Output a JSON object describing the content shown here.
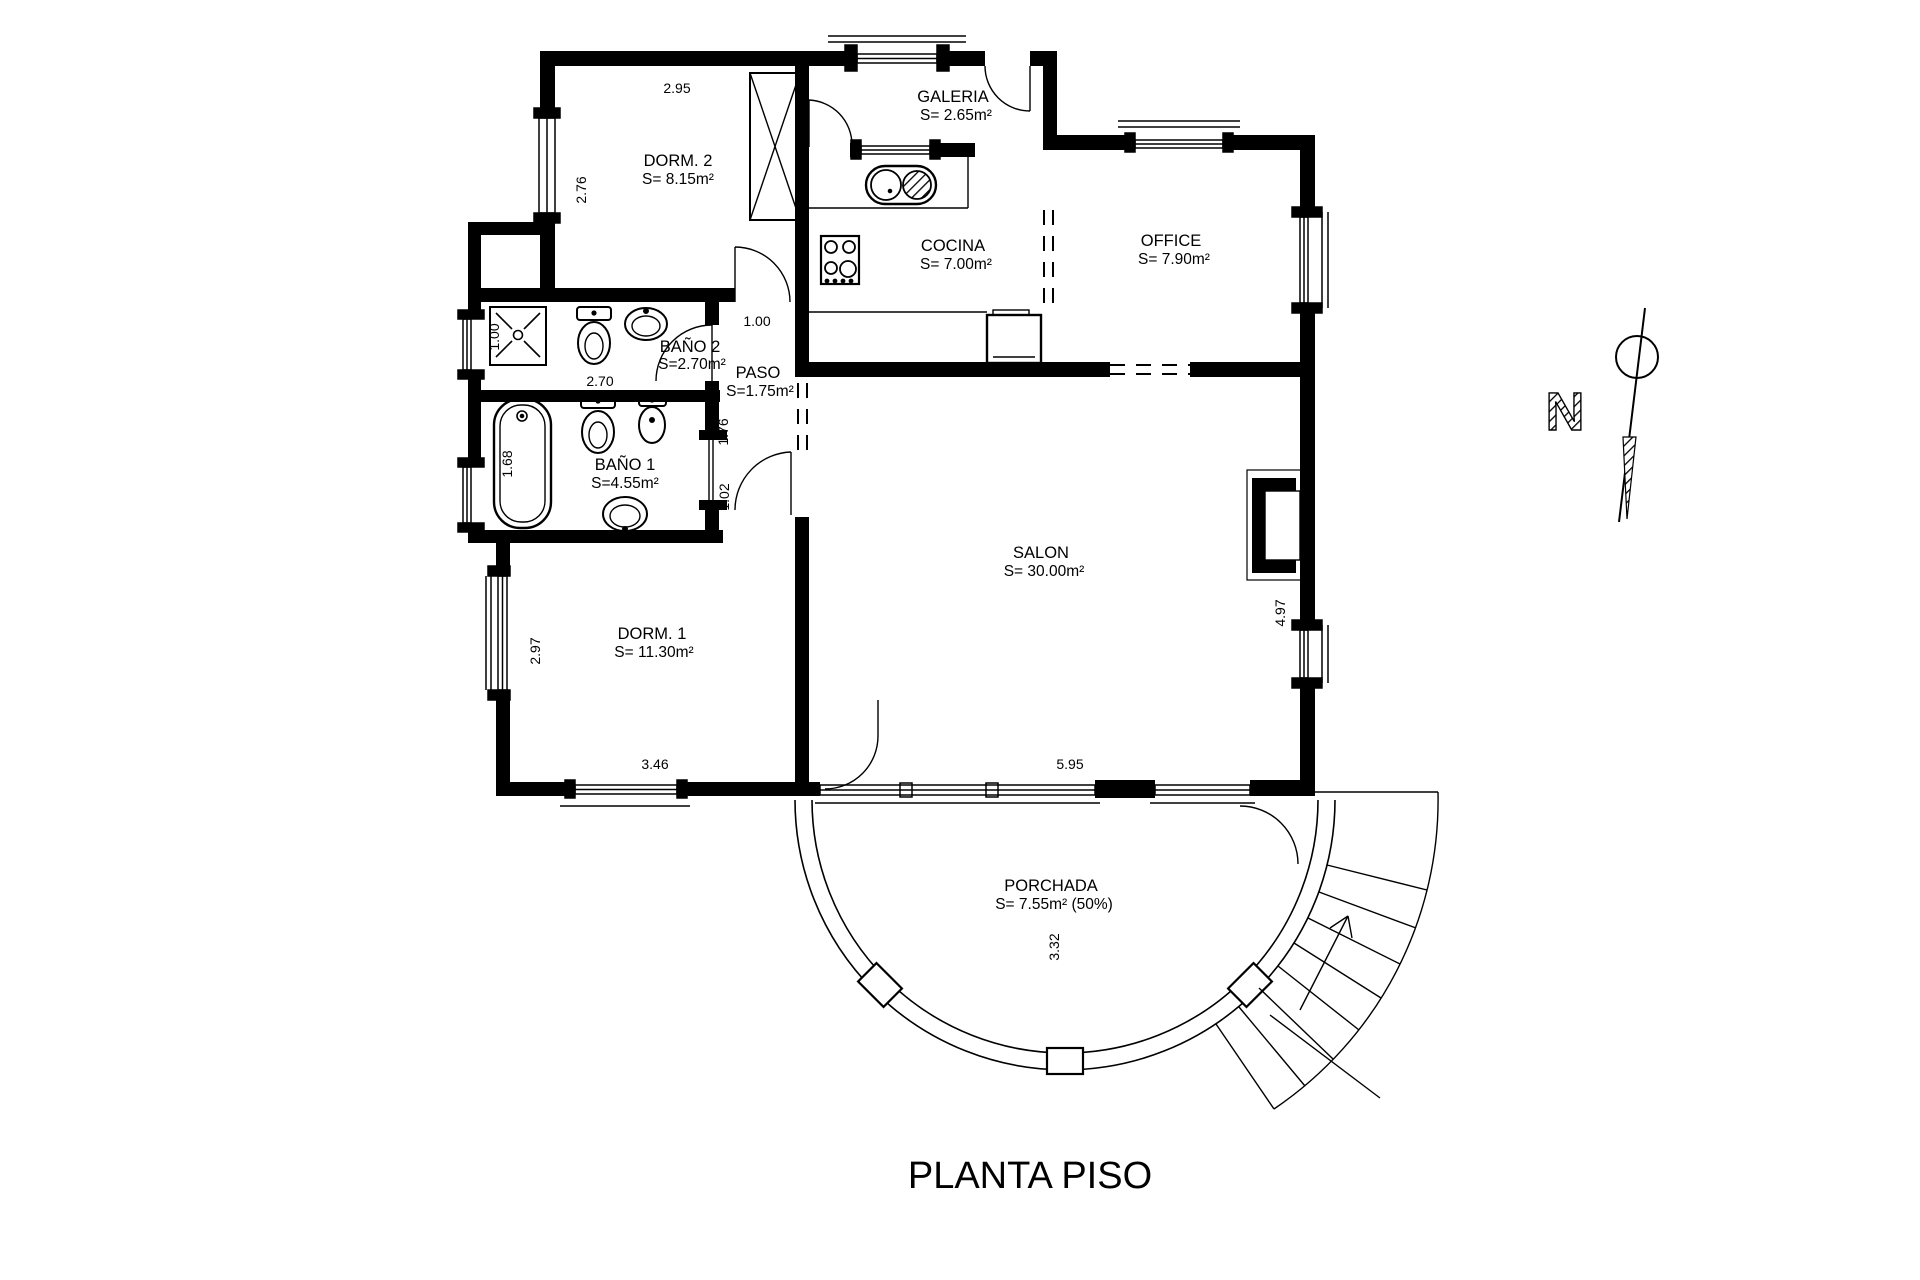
{
  "title": "PLANTA PISO",
  "north": {
    "label": "N"
  },
  "colors": {
    "line": "#000000",
    "background": "#ffffff"
  },
  "rooms": {
    "dorm2": {
      "name": "DORM. 2",
      "area": "S= 8.15m²"
    },
    "galeria": {
      "name": "GALERIA",
      "area": "S= 2.65m²"
    },
    "cocina": {
      "name": "COCINA",
      "area": "S= 7.00m²"
    },
    "office": {
      "name": "OFFICE",
      "area": "S= 7.90m²"
    },
    "bano2": {
      "name": "BAÑO 2",
      "area": "S=2.70m²"
    },
    "paso": {
      "name": "PASO",
      "area": "S=1.75m²"
    },
    "bano1": {
      "name": "BAÑO 1",
      "area": "S=4.55m²"
    },
    "dorm1": {
      "name": "DORM. 1",
      "area": "S= 11.30m²"
    },
    "salon": {
      "name": "SALON",
      "area": "S= 30.00m²"
    },
    "porchada": {
      "name": "PORCHADA",
      "area": "S= 7.55m²  (50%)"
    }
  },
  "dimensions": {
    "dorm2_width": "2.95",
    "dorm2_height": "2.76",
    "shower_width": "1.00",
    "bano2_width": "2.70",
    "paso_width": "1.00",
    "paso_length": "1.76",
    "paso_door": "1.02",
    "bathtub_length": "1.68",
    "dorm1_height": "2.97",
    "dorm1_width": "3.46",
    "salon_width": "5.95",
    "salon_height": "4.97",
    "porch_depth": "3.32"
  }
}
